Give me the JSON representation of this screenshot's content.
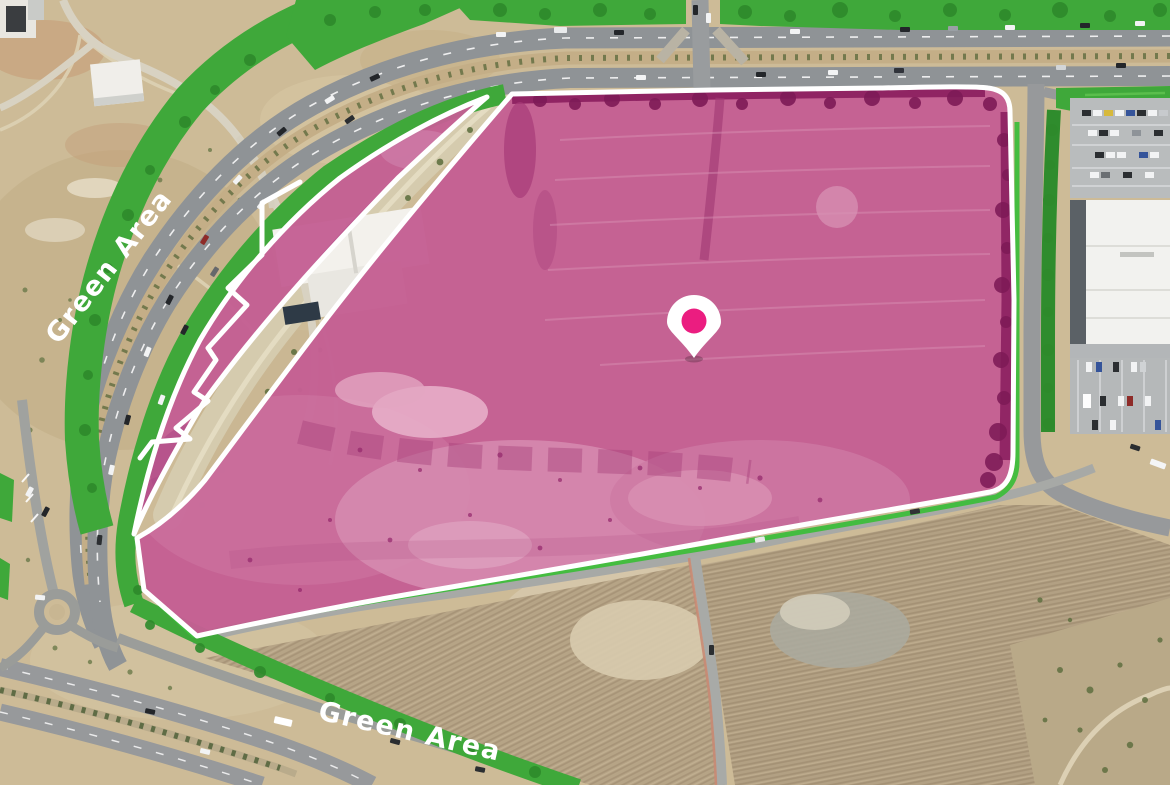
{
  "map": {
    "description": "Aerial drone photograph showing highlighted land plots beside a highway",
    "labels": {
      "green_area_left": "Green Area",
      "green_area_bottom": "Green Area"
    },
    "marker": {
      "name": "location-pin",
      "fill": "#eb1d80",
      "outline": "#ffffff"
    },
    "colors": {
      "plot_fill": "#c45f93",
      "plot_fill_dark": "#8a1e5e",
      "plot_fill_light": "#d98fb4",
      "plot_border": "#ffffff",
      "green_overlay": "#3fa83a",
      "label_text": "#ffffff"
    }
  }
}
